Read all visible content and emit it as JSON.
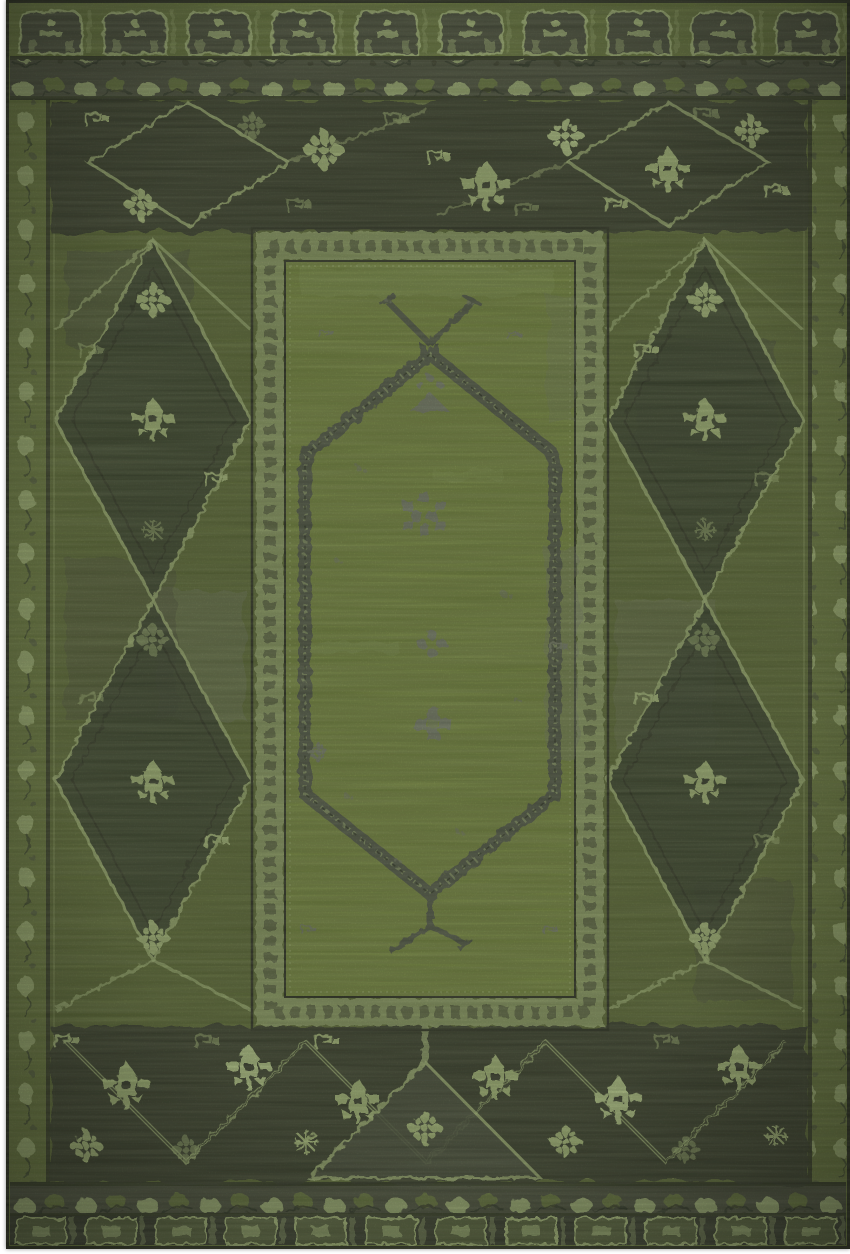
{
  "meta": {
    "subject": "Top-down product photograph of an overdyed vintage-style oriental area rug in green",
    "alt": "Distressed green Persian-style rug: dark charcoal geometric borders with pale green palmette flowers and diamond lattice sides, an inner bright olive-green panel framed by a key-pattern band, and a tall hexagonal medallion outlined in speckled charcoal with X-shaped finials and small gray floral clusters"
  },
  "palette": {
    "page_bg": "#ffffff",
    "edge": "#1b1e15",
    "field": "#6e803a",
    "field_dark": "#5d6c33",
    "panel": "#7f9340",
    "pale": "#b7cc86",
    "pale_bright": "#c9df99",
    "olive": "#6c7d3c",
    "olive_dark": "#55603a",
    "charcoal": "#2e3228",
    "charcoal_soft": "#44483a",
    "band_gray": "#50544a",
    "frame_band": "#9fb273",
    "gray": "#7d8373",
    "ink": "#20231a"
  },
  "rug": {
    "structure": {
      "outer_top_band": "row of arch / tombstone panels",
      "scroll_bands": "leaf and vine scroll guard bands top and bottom",
      "side_guards": "narrow pale vine guard stripes left and right",
      "main_border": "wide charcoal border with palmettes, rosettes, zigzag diamond lattice on sides",
      "inner_panel": "bright green field framed by pale key-pattern band",
      "medallion": "elongated hexagon outlined in speckled charcoal with X top finial and Y bottom finial"
    },
    "motifs": [
      {
        "t": "palmette",
        "x": 480,
        "y": 186,
        "s": 1.1,
        "c": "pale"
      },
      {
        "t": "palmette",
        "x": 662,
        "y": 170,
        "s": 1.0,
        "c": "pale"
      },
      {
        "t": "flower8",
        "x": 318,
        "y": 150,
        "s": 1.0,
        "c": "pale"
      },
      {
        "t": "flower8",
        "x": 560,
        "y": 136,
        "s": 0.9,
        "c": "bright"
      },
      {
        "t": "flower8",
        "x": 135,
        "y": 205,
        "s": 0.8,
        "c": "pale"
      },
      {
        "t": "flower8",
        "x": 745,
        "y": 131,
        "s": 0.8,
        "c": "pale"
      },
      {
        "t": "flower8",
        "x": 246,
        "y": 126,
        "s": 0.7,
        "c": "dim"
      },
      {
        "t": "keybit",
        "x": 90,
        "y": 120,
        "s": 1,
        "c": "pale"
      },
      {
        "t": "keybit",
        "x": 390,
        "y": 120,
        "s": 1,
        "c": "dim"
      },
      {
        "t": "keybit",
        "x": 432,
        "y": 158,
        "s": 1,
        "c": "pale"
      },
      {
        "t": "keybit",
        "x": 520,
        "y": 210,
        "s": 1,
        "c": "dim"
      },
      {
        "t": "keybit",
        "x": 610,
        "y": 206,
        "s": 1,
        "c": "pale"
      },
      {
        "t": "keybit",
        "x": 700,
        "y": 115,
        "s": 1,
        "c": "dim"
      },
      {
        "t": "keybit",
        "x": 770,
        "y": 192,
        "s": 1,
        "c": "pale"
      },
      {
        "t": "keybit",
        "x": 292,
        "y": 206,
        "s": 1,
        "c": "dim"
      },
      {
        "t": "palmette",
        "x": 147,
        "y": 420,
        "s": 0.95,
        "c": "pale"
      },
      {
        "t": "palmette",
        "x": 147,
        "y": 782,
        "s": 0.95,
        "c": "pale"
      },
      {
        "t": "flower8",
        "x": 147,
        "y": 300,
        "s": 0.85,
        "c": "pale"
      },
      {
        "t": "flower8",
        "x": 147,
        "y": 640,
        "s": 0.8,
        "c": "dim"
      },
      {
        "t": "flower8",
        "x": 147,
        "y": 938,
        "s": 0.8,
        "c": "pale"
      },
      {
        "t": "keybit",
        "x": 85,
        "y": 352,
        "s": 1,
        "c": "dim"
      },
      {
        "t": "keybit",
        "x": 210,
        "y": 480,
        "s": 1,
        "c": "pale"
      },
      {
        "t": "keybit",
        "x": 85,
        "y": 700,
        "s": 1,
        "c": "dim"
      },
      {
        "t": "keybit",
        "x": 210,
        "y": 842,
        "s": 1,
        "c": "pale"
      },
      {
        "t": "snowflake",
        "x": 147,
        "y": 530,
        "s": 0.8,
        "c": "dim"
      },
      {
        "t": "palmette",
        "x": 699,
        "y": 420,
        "s": 0.95,
        "c": "pale"
      },
      {
        "t": "palmette",
        "x": 699,
        "y": 782,
        "s": 0.95,
        "c": "pale"
      },
      {
        "t": "flower8",
        "x": 699,
        "y": 300,
        "s": 0.85,
        "c": "pale"
      },
      {
        "t": "flower8",
        "x": 699,
        "y": 640,
        "s": 0.8,
        "c": "dim"
      },
      {
        "t": "flower8",
        "x": 699,
        "y": 938,
        "s": 0.8,
        "c": "pale"
      },
      {
        "t": "keybit",
        "x": 640,
        "y": 352,
        "s": 1,
        "c": "pale"
      },
      {
        "t": "keybit",
        "x": 760,
        "y": 480,
        "s": 1,
        "c": "dim"
      },
      {
        "t": "keybit",
        "x": 640,
        "y": 700,
        "s": 1,
        "c": "pale"
      },
      {
        "t": "keybit",
        "x": 760,
        "y": 842,
        "s": 1,
        "c": "dim"
      },
      {
        "t": "snowflake",
        "x": 699,
        "y": 530,
        "s": 0.8,
        "c": "dim"
      },
      {
        "t": "palmette",
        "x": 120,
        "y": 1086,
        "s": 1.05,
        "c": "pale"
      },
      {
        "t": "palmette",
        "x": 243,
        "y": 1068,
        "s": 1.0,
        "c": "bright"
      },
      {
        "t": "palmette",
        "x": 352,
        "y": 1102,
        "s": 1.0,
        "c": "pale"
      },
      {
        "t": "palmette",
        "x": 489,
        "y": 1078,
        "s": 1.0,
        "c": "pale"
      },
      {
        "t": "palmette",
        "x": 612,
        "y": 1100,
        "s": 1.05,
        "c": "bright"
      },
      {
        "t": "palmette",
        "x": 733,
        "y": 1068,
        "s": 1.0,
        "c": "pale"
      },
      {
        "t": "flower8",
        "x": 80,
        "y": 1146,
        "s": 0.8,
        "c": "pale"
      },
      {
        "t": "flower8",
        "x": 560,
        "y": 1142,
        "s": 0.8,
        "c": "pale"
      },
      {
        "t": "flower8",
        "x": 680,
        "y": 1150,
        "s": 0.7,
        "c": "dim"
      },
      {
        "t": "flower8",
        "x": 180,
        "y": 1150,
        "s": 0.7,
        "c": "dim"
      },
      {
        "t": "flower8",
        "x": 419,
        "y": 1128,
        "s": 0.85,
        "c": "pale"
      },
      {
        "t": "snowflake",
        "x": 300,
        "y": 1142,
        "s": 0.9,
        "c": "pale"
      },
      {
        "t": "snowflake",
        "x": 770,
        "y": 1136,
        "s": 0.8,
        "c": "pale"
      },
      {
        "t": "keybit",
        "x": 200,
        "y": 1042,
        "s": 1,
        "c": "dim"
      },
      {
        "t": "keybit",
        "x": 320,
        "y": 1042,
        "s": 1,
        "c": "pale"
      },
      {
        "t": "keybit",
        "x": 660,
        "y": 1042,
        "s": 1,
        "c": "dim"
      },
      {
        "t": "keybit",
        "x": 60,
        "y": 1042,
        "s": 1,
        "c": "pale"
      },
      {
        "t": "grayarrow",
        "x": 424,
        "y": 398,
        "s": 1,
        "c": "gray",
        "layer": "panel"
      },
      {
        "t": "graycluster",
        "x": 418,
        "y": 514,
        "s": 1,
        "c": "gray",
        "layer": "panel"
      },
      {
        "t": "graydots",
        "x": 426,
        "y": 644,
        "s": 1,
        "c": "gray",
        "layer": "panel"
      },
      {
        "t": "grayplus",
        "x": 427,
        "y": 724,
        "s": 1,
        "c": "gray",
        "layer": "panel"
      },
      {
        "t": "keybit",
        "x": 320,
        "y": 334,
        "s": 0.6,
        "c": "gray",
        "layer": "panel"
      },
      {
        "t": "keybit",
        "x": 508,
        "y": 336,
        "s": 0.6,
        "c": "gray",
        "layer": "panel"
      },
      {
        "t": "flower8",
        "x": 312,
        "y": 752,
        "s": 0.5,
        "c": "gray",
        "layer": "panel"
      },
      {
        "t": "keybit",
        "x": 552,
        "y": 648,
        "s": 0.8,
        "c": "gray",
        "layer": "panel"
      },
      {
        "t": "keybit",
        "x": 302,
        "y": 930,
        "s": 0.6,
        "c": "gray",
        "layer": "panel"
      },
      {
        "t": "keybit",
        "x": 544,
        "y": 930,
        "s": 0.6,
        "c": "gray",
        "layer": "panel"
      },
      {
        "t": "speck",
        "x": 352,
        "y": 468,
        "s": 1,
        "c": "gray",
        "layer": "panel"
      },
      {
        "t": "speck",
        "x": 498,
        "y": 594,
        "s": 1.2,
        "c": "gray",
        "layer": "panel"
      },
      {
        "t": "speck",
        "x": 340,
        "y": 796,
        "s": 1,
        "c": "gray",
        "layer": "panel"
      },
      {
        "t": "speck",
        "x": 452,
        "y": 832,
        "s": 0.8,
        "c": "gray",
        "layer": "panel"
      },
      {
        "t": "speck",
        "x": 330,
        "y": 560,
        "s": 0.8,
        "c": "gray",
        "layer": "panel"
      },
      {
        "t": "speck",
        "x": 510,
        "y": 700,
        "s": 0.8,
        "c": "gray",
        "layer": "panel"
      },
      {
        "t": "speck",
        "x": 390,
        "y": 860,
        "s": 0.7,
        "c": "gray",
        "layer": "panel"
      },
      {
        "t": "speck",
        "x": 462,
        "y": 302,
        "s": 0.7,
        "c": "gray",
        "layer": "panel"
      },
      {
        "t": "speck",
        "x": 380,
        "y": 300,
        "s": 0.6,
        "c": "gray",
        "layer": "panel"
      }
    ]
  }
}
